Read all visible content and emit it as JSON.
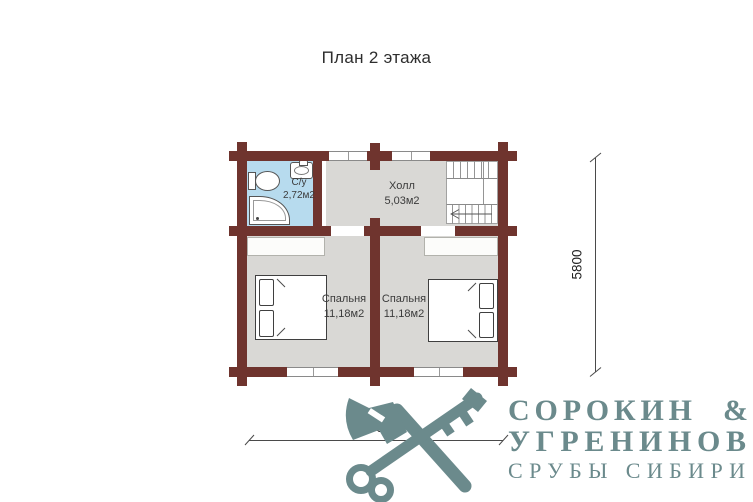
{
  "title": "План 2 этажа",
  "plan": {
    "rooms": {
      "bathroom": {
        "name": "С/у",
        "area": "2,72м2"
      },
      "hall": {
        "name": "Холл",
        "area": "5,03м2"
      },
      "bedroom_left": {
        "name": "Спальня",
        "area": "11,18м2"
      },
      "bedroom_right": {
        "name": "Спальня",
        "area": "11,18м2"
      }
    },
    "dimensions": {
      "horizontal": "6800",
      "vertical": "5800"
    }
  },
  "logo": {
    "name_top": "СОРОКИН",
    "ampersand": "&",
    "name_bottom": "УГРЕНИНОВ",
    "tagline": "СРУБЫ СИБИРИ"
  },
  "icons": {
    "logo": [
      "axe-icon",
      "key-icon"
    ],
    "bathroom": [
      "toilet-icon",
      "sink-icon",
      "shower-icon"
    ]
  },
  "colors": {
    "wall": "#6f342e",
    "floor": "#d9d8d5",
    "bathroom_floor": "#b7dbee",
    "logo": "#6b8a8c"
  }
}
